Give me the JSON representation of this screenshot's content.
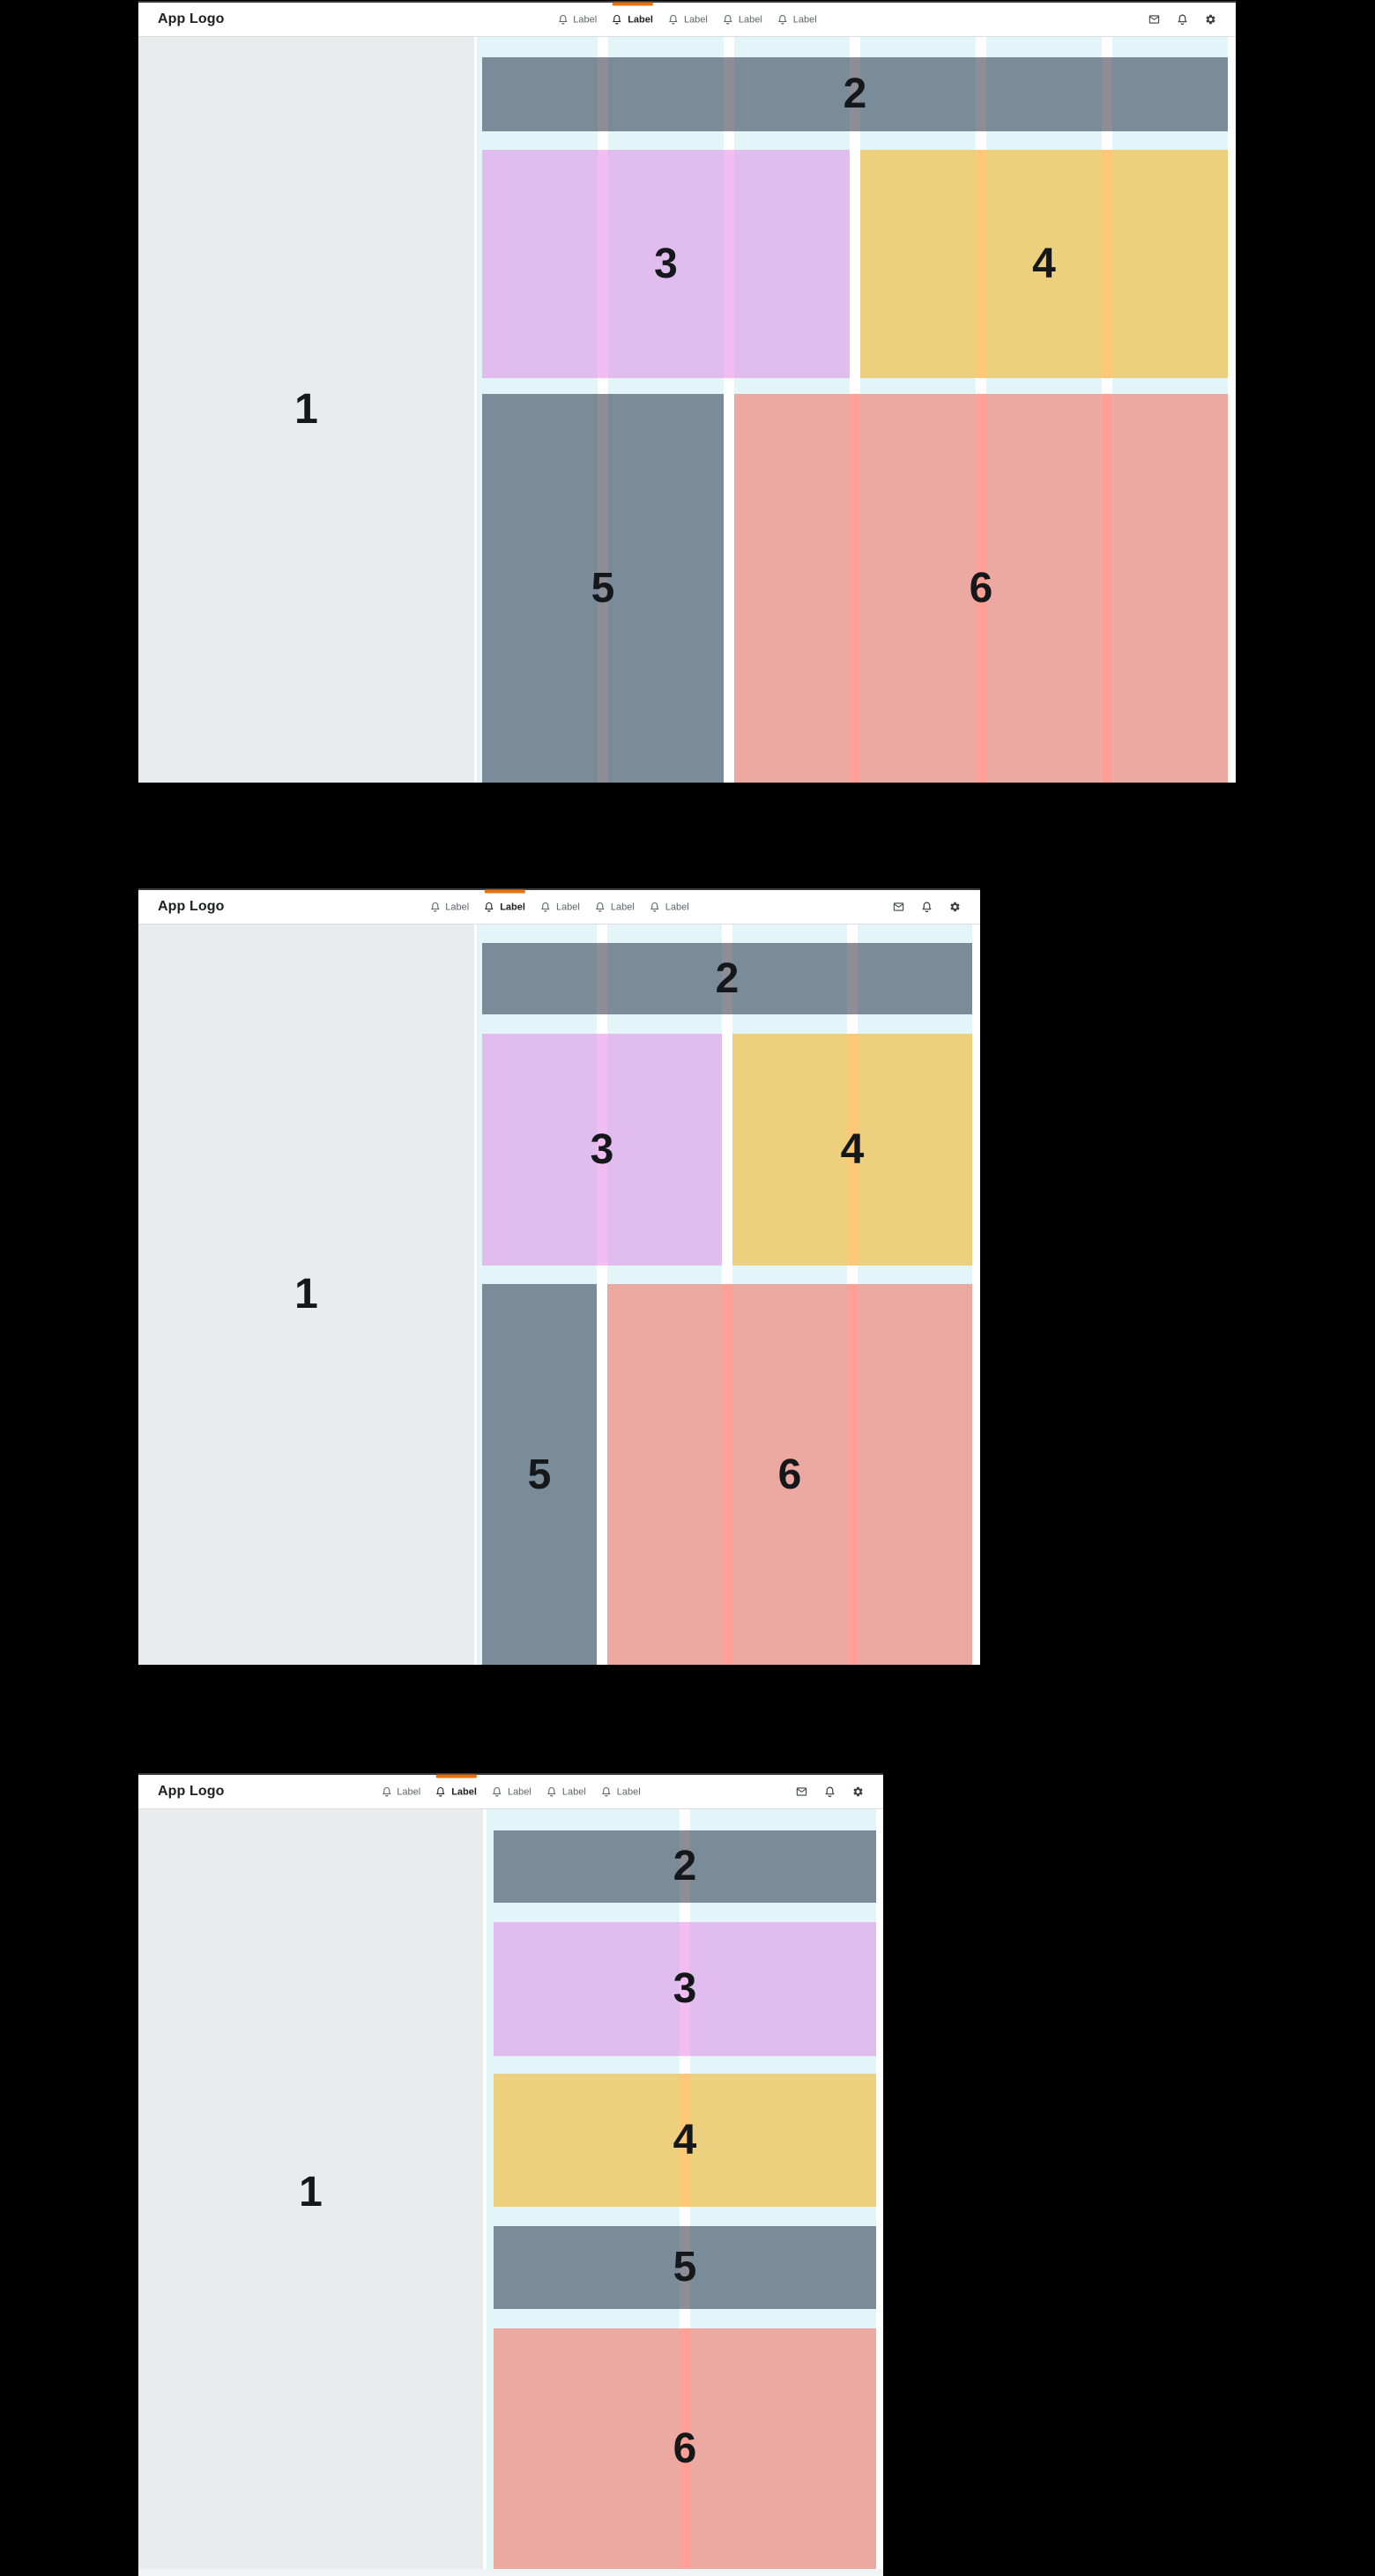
{
  "app": {
    "title": "App Logo"
  },
  "nav": {
    "items": [
      {
        "label": "Label"
      },
      {
        "label": "Label"
      },
      {
        "label": "Label"
      },
      {
        "label": "Label"
      },
      {
        "label": "Label"
      }
    ],
    "active_index": 1
  },
  "header_icons": [
    {
      "name": "mail"
    },
    {
      "name": "notifications"
    },
    {
      "name": "settings"
    }
  ],
  "regions": {
    "r1": "1",
    "r2": "2",
    "r3": "3",
    "r4": "4",
    "r5": "5",
    "r6": "6"
  },
  "frames": [
    {
      "columns": 6
    },
    {
      "columns": 4
    },
    {
      "columns": 2
    }
  ],
  "colors": {
    "accent_orange": "#e8710a",
    "header_bg": "#ffffff",
    "header_border": "#dadce0",
    "frame_top_border": "#393d42",
    "sidebar_gray": "#e9eced",
    "azure_column": "#e4f5f9",
    "gutter_white": "#ffffff",
    "slate": "#7a8c99",
    "slate_stripe": "#8d8d96",
    "purple": "#e1bcee",
    "purple_stripe": "#f2bef2",
    "yellow": "#ecd07e",
    "yellow_stripe": "#fec878",
    "salmon": "#eba9a2",
    "salmon_stripe": "#ff9f95",
    "number_ink": "#15181b",
    "nav_text": "#5f6368",
    "nav_text_active": "#202124",
    "bottom_strip": "#f1f4f5"
  }
}
